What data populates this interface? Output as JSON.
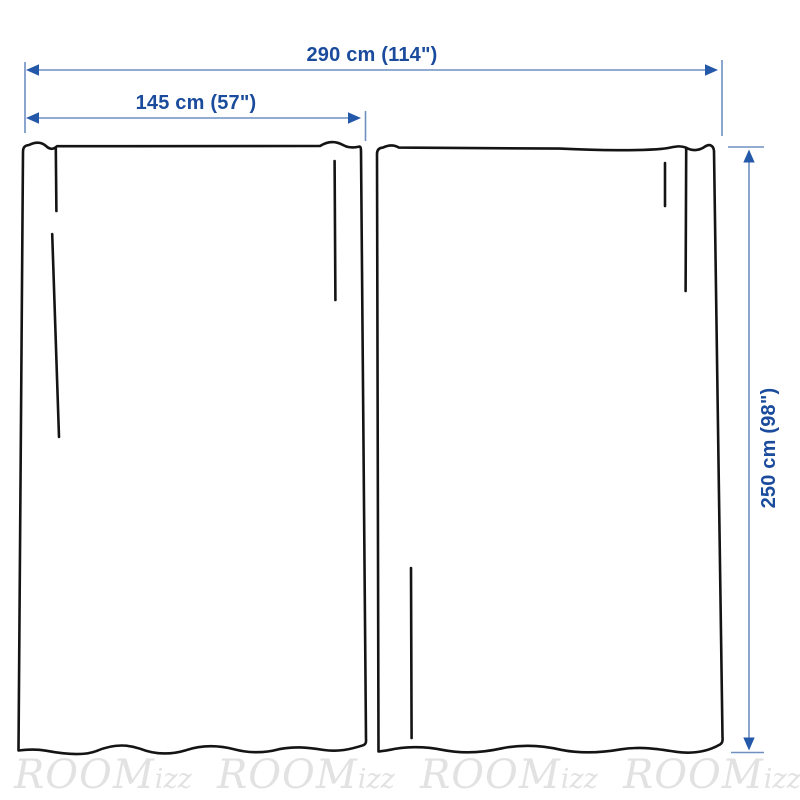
{
  "diagram": {
    "dimensions": {
      "total_width_label": "290 cm (114\")",
      "panel_width_label": "145 cm (57\")",
      "height_label": "250 cm (98\")"
    },
    "watermarks": [
      {
        "main": "ROOM",
        "suffix": "izz"
      },
      {
        "main": "ROOM",
        "suffix": "izz"
      },
      {
        "main": "ROOM",
        "suffix": "izz"
      },
      {
        "main": "ROOM",
        "suffix": "izz"
      }
    ],
    "colors": {
      "dimension_text": "#1a4b9c",
      "dimension_line": "#6e8fc0",
      "dimension_arrow": "#2458a8",
      "curtain_outline": "#141414",
      "watermark": "#e2e2e2",
      "background": "#ffffff"
    }
  }
}
